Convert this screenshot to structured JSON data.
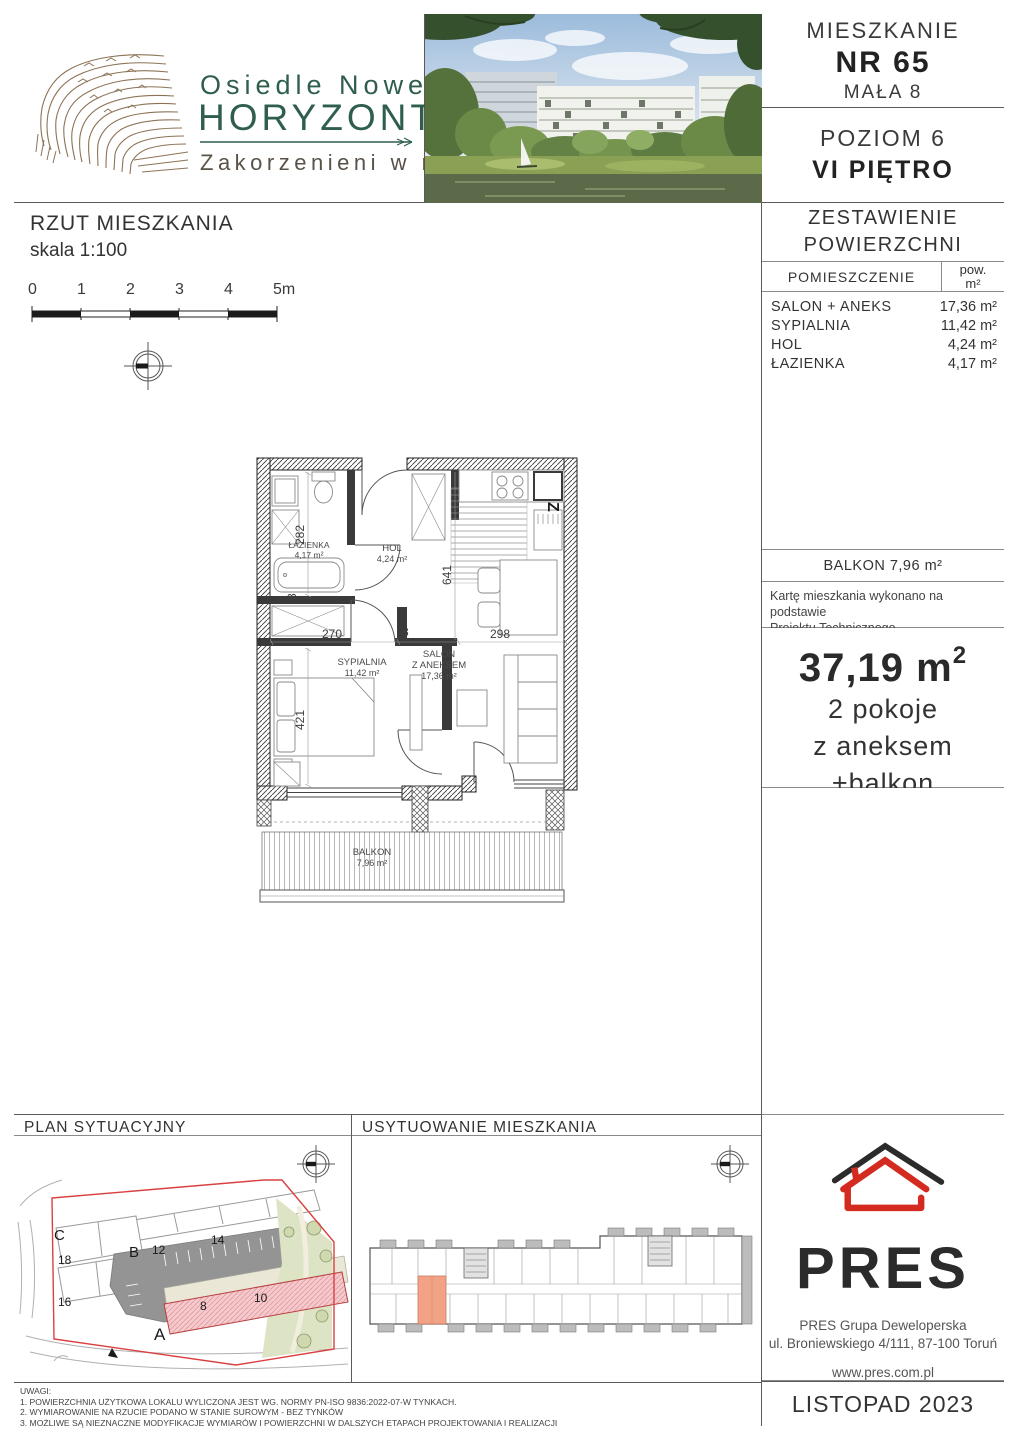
{
  "logo": {
    "line1": "Osiedle Nowe",
    "line2": "HORYZONTY",
    "tagline": "Zakorzenieni w naturze"
  },
  "header": {
    "apartment_label": "MIESZKANIE",
    "apartment_no": "NR 65",
    "street": "MAŁA 8",
    "level": "POZIOM 6",
    "floor": "VI PIĘTRO"
  },
  "plan": {
    "title": "RZUT MIESZKANIA",
    "scale": "skala 1:100",
    "scale_ticks": [
      "0",
      "1",
      "2",
      "3",
      "4",
      "5m"
    ],
    "rooms": {
      "lazienka_name": "ŁAZIENKA",
      "lazienka_area": "4,17 m²",
      "hol_name": "HOL",
      "hol_area": "4,24 m²",
      "sypialnia_name": "SYPIALNIA",
      "sypialnia_area": "11,42 m²",
      "salon_l1": "SALON",
      "salon_l2": "Z ANEKSEM",
      "salon_area": "17,36 m²",
      "balkon_name": "BALKON",
      "balkon_area": "7,96 m²"
    },
    "dims": {
      "d282": "282",
      "d270": "270",
      "d8a": "8",
      "d8b": "8",
      "d641": "641",
      "d298": "298",
      "d421": "421"
    },
    "entrance_marker": "Z"
  },
  "areas_table": {
    "title_l1": "ZESTAWIENIE",
    "title_l2": "POWIERZCHNI",
    "col_room": "POMIESZCZENIE",
    "col_area_l1": "pow.",
    "col_area_l2": "m²",
    "rows": [
      {
        "name": "SALON + ANEKS",
        "value": "17,36 m²"
      },
      {
        "name": "SYPIALNIA",
        "value": "11,42 m²"
      },
      {
        "name": "HOL",
        "value": "4,24 m²"
      },
      {
        "name": "ŁAZIENKA",
        "value": "4,17 m²"
      }
    ],
    "balkon_row": "BALKON 7,96 m²"
  },
  "note": {
    "l1": "Kartę mieszkania wykonano na podstawie",
    "l2": "Projektu Technicznego."
  },
  "summary": {
    "area_main": "37,19 m",
    "area_sup": "2",
    "line1": "2 pokoje",
    "line2": "z aneksem",
    "line3": "+balkon"
  },
  "bottom": {
    "site_title": "PLAN SYTUACYJNY",
    "unit_title": "USYTUOWANIE MIESZKANIA",
    "site_labels": {
      "A": "A",
      "B": "B",
      "C": "C",
      "n8": "8",
      "n10": "10",
      "n12": "12",
      "n14": "14",
      "n16": "16",
      "n18": "18"
    }
  },
  "pres": {
    "name": "PRES",
    "company": "PRES Grupa Deweloperska",
    "address": "ul. Broniewskiego 4/111, 87-100 Toruń",
    "website": "www.pres.com.pl",
    "date": "LISTOPAD 2023"
  },
  "uwagi": {
    "title": "UWAGI:",
    "l1": "1. POWIERZCHNIA UŻYTKOWA LOKALU WYLICZONA JEST WG. NORMY PN-ISO 9836:2022-07-W TYNKACH.",
    "l2": "2. WYMIAROWANIE NA RZUCIE PODANO W STANIE SUROWYM - BEZ TYNKÓW",
    "l3": "3. MOŻLIWE SĄ NIEZNACZNE MODYFIKACJE WYMIARÓW I POWIERZCHNI W DALSZYCH ETAPACH PROJEKTOWANIA I REALIZACJI"
  },
  "colors": {
    "accent_red": "#d42b20",
    "logo_green": "#2f5f4c",
    "logo_brown": "#8c7356",
    "highlight_orange": "#f2a285",
    "site_pink": "#f6c9cc",
    "site_red": "#d94040"
  }
}
